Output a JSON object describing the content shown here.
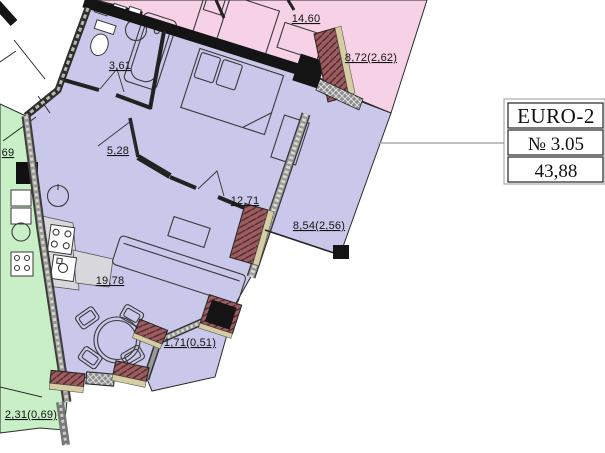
{
  "plan": {
    "unit_table": {
      "type_label": "EURO-2",
      "number_label": "№ 3.05",
      "area_label": "43,88"
    },
    "rooms": [
      {
        "id": "neighbor-bedroom",
        "area": "14,60"
      },
      {
        "id": "neighbor-balcony",
        "area": "8,72(2,62)"
      },
      {
        "id": "bathroom",
        "area": "3,61"
      },
      {
        "id": "hallway",
        "area": "5,28"
      },
      {
        "id": "bedroom",
        "area": "12,71"
      },
      {
        "id": "balcony-right",
        "area": "8,54(2,56)"
      },
      {
        "id": "living-kitchen",
        "area": "19,78"
      },
      {
        "id": "balcony-bottom",
        "area": "1,71(0,51)"
      },
      {
        "id": "neighbor-green-balcony",
        "area": "2,31(0,69)"
      },
      {
        "id": "neighbor-left-partial",
        "area": "69"
      }
    ],
    "colors": {
      "unit_fill": "#c9c7ea",
      "neighbor_top_fill": "#f7d2e7",
      "neighbor_left_fill": "#c9efc6",
      "wall": "#141414",
      "brick": "#9c5d60",
      "sill": "#d6cda2",
      "parapet": "#8d8d8d",
      "leader_line": "#aaaaaa"
    }
  }
}
